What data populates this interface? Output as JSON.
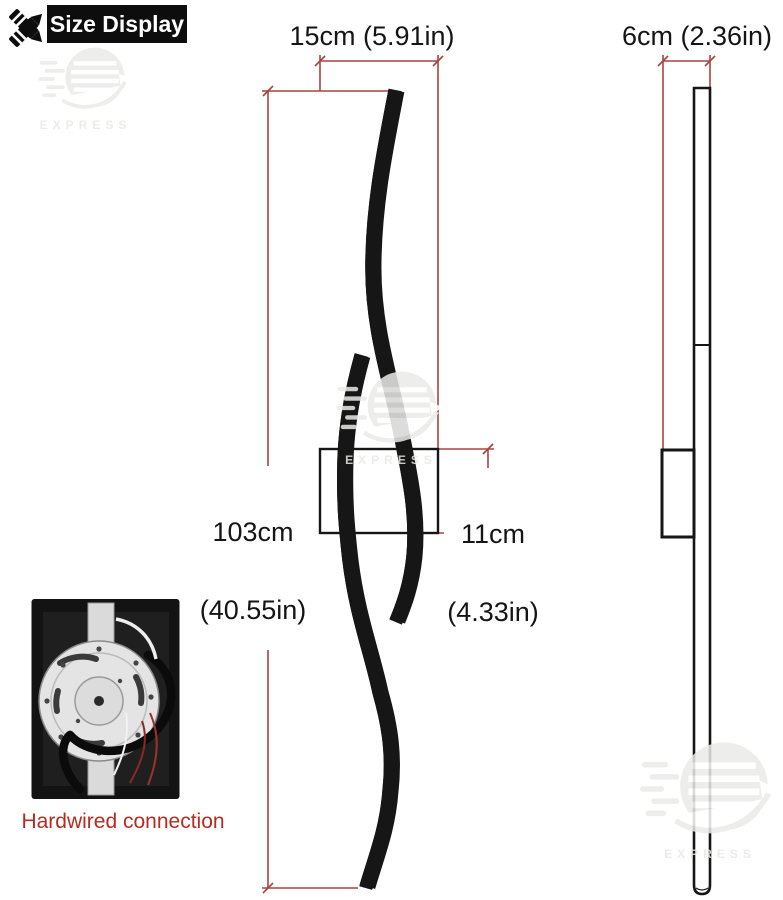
{
  "badge": {
    "label": "Size Display"
  },
  "dimensions": {
    "width": "15cm (5.91in)",
    "height": [
      "103cm",
      "(40.55in)"
    ],
    "bracket_height": [
      "11cm",
      "(4.33in)"
    ],
    "depth": "6cm (2.36in)"
  },
  "caption": "Hardwired connection",
  "watermark": {
    "text": "EXPRESS"
  },
  "colors": {
    "dimension_line": "#a8433f",
    "caption_text": "#b62c20",
    "line_art": "#161616",
    "badge_bg": "#0d0d0d"
  }
}
